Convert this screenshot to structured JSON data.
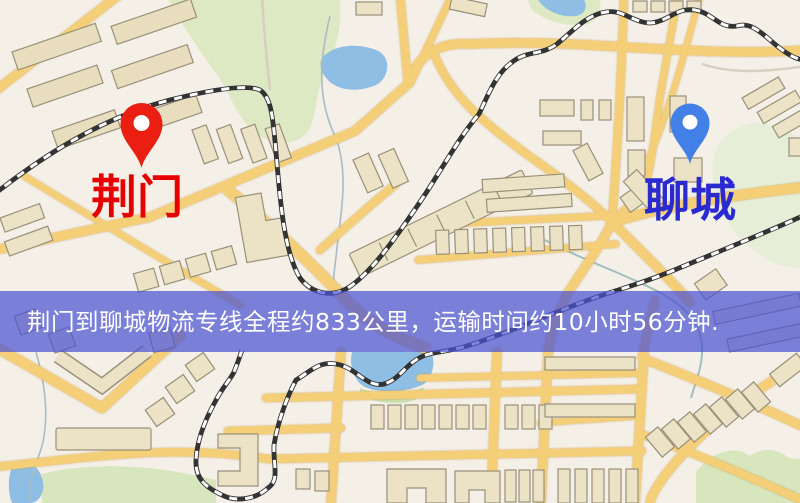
{
  "map": {
    "origin_label": "荆门",
    "destination_label": "聊城",
    "origin_marker_icon": "red-map-pin",
    "destination_marker_icon": "blue-map-pin"
  },
  "banner": {
    "text": "荆门到聊城物流专线全程约833公里，运输时间约10小时56分钟."
  },
  "colors": {
    "background": "#F4EFE7",
    "park_green": "#DDE9C2",
    "field_green": "#D8E6BE",
    "forest_green": "#E6EED8",
    "water_blue": "#8FBEE4",
    "road_yellow": "#F5CF78",
    "railway_dark": "#333333",
    "building_fill": "#ECE3C6",
    "building_stroke": "#99907A",
    "origin_pin": "#EA1F12",
    "origin_label": "#E60000",
    "destination_pin": "#4280E8",
    "destination_label": "#2A2AD0",
    "banner_bg": "rgba(75,83,211,0.72)",
    "banner_text": "#FFFFFF"
  }
}
